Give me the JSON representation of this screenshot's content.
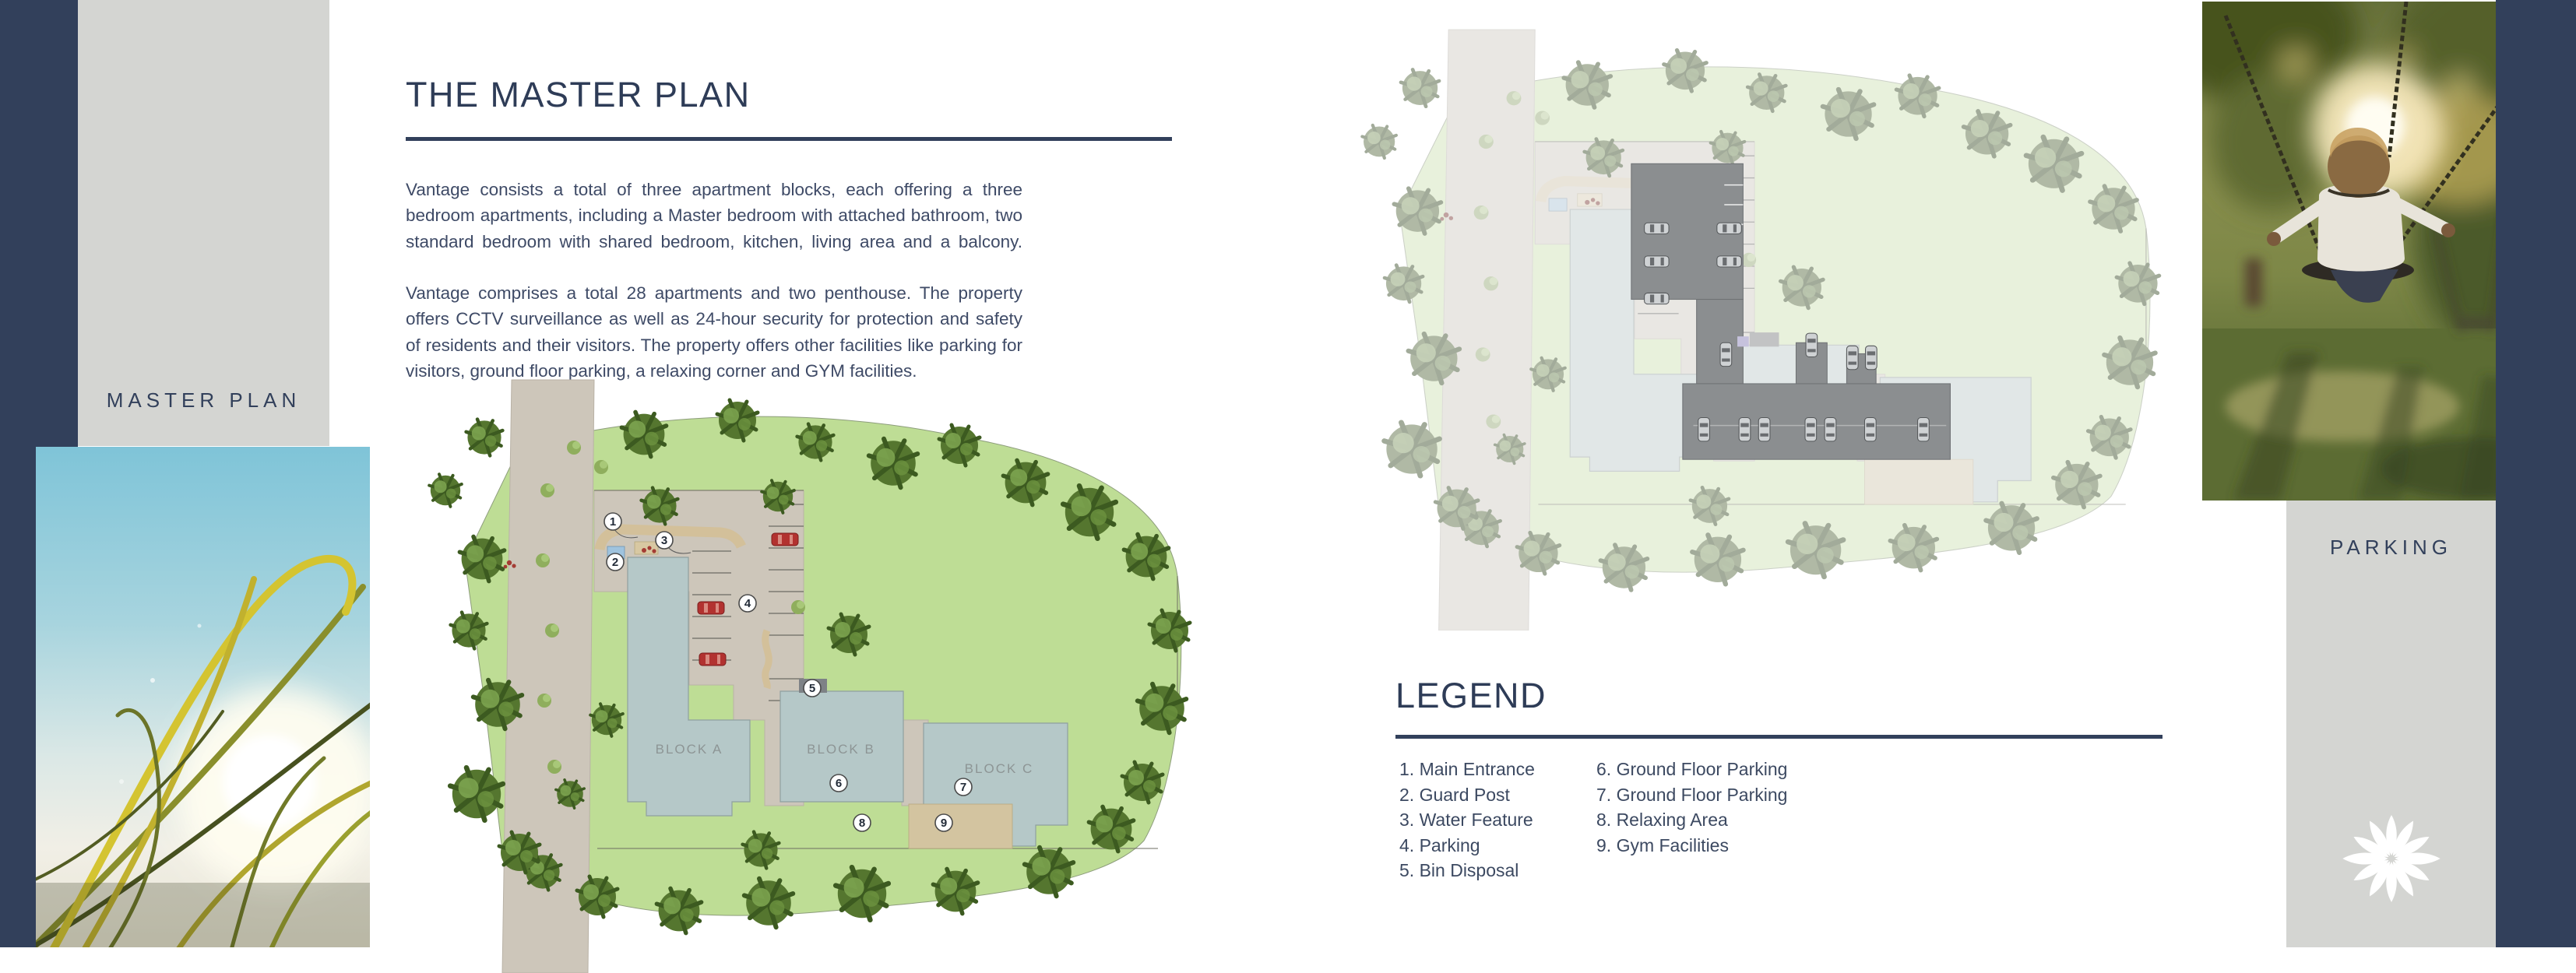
{
  "colors": {
    "navy": "#32405b",
    "panel_gray": "#d4d5d2",
    "heading": "#2e3c57",
    "body_text": "#3e4a66",
    "plan_grass": "#bcdc92",
    "plan_road": "#cdc6ba",
    "plan_building": "#b5c8c8",
    "plan_parking_overlay": "#8b8e90",
    "plan_tan": "#d3c09a"
  },
  "sidebar_left": {
    "label": "MASTER PLAN"
  },
  "sidebar_right": {
    "label": "PARKING"
  },
  "intro": {
    "title": "THE MASTER PLAN",
    "p1": "Vantage consists a total of three apartment blocks, each offering a three bedroom apartments, including a Master bedroom with attached bathroom, two standard bedroom with shared bedroom, kitchen, living area and a balcony.",
    "p2": "Vantage comprises a total 28 apartments and two penthouse. The property offers CCTV surveillance as well as 24-hour security for protection and safety of residents and their visitors. The property offers other facilities like parking for visitors, ground floor parking, a relaxing corner and GYM facilities."
  },
  "legend": {
    "title": "LEGEND",
    "items": [
      "1. Main Entrance",
      "2. Guard Post",
      "3. Water Feature",
      "4. Parking",
      "5. Bin Disposal",
      "6. Ground Floor Parking",
      "7. Ground Floor Parking",
      "8. Relaxing Area",
      "9. Gym Facilities"
    ]
  },
  "plan1": {
    "name": "master plan site map",
    "blocks": [
      "BLOCK A",
      "BLOCK B",
      "BLOCK C"
    ],
    "markers": [
      "1",
      "2",
      "3",
      "4",
      "5",
      "6",
      "7",
      "8",
      "9"
    ]
  },
  "plan2": {
    "name": "ground floor parking site map"
  },
  "icons": {
    "logo": "flower-logo"
  }
}
